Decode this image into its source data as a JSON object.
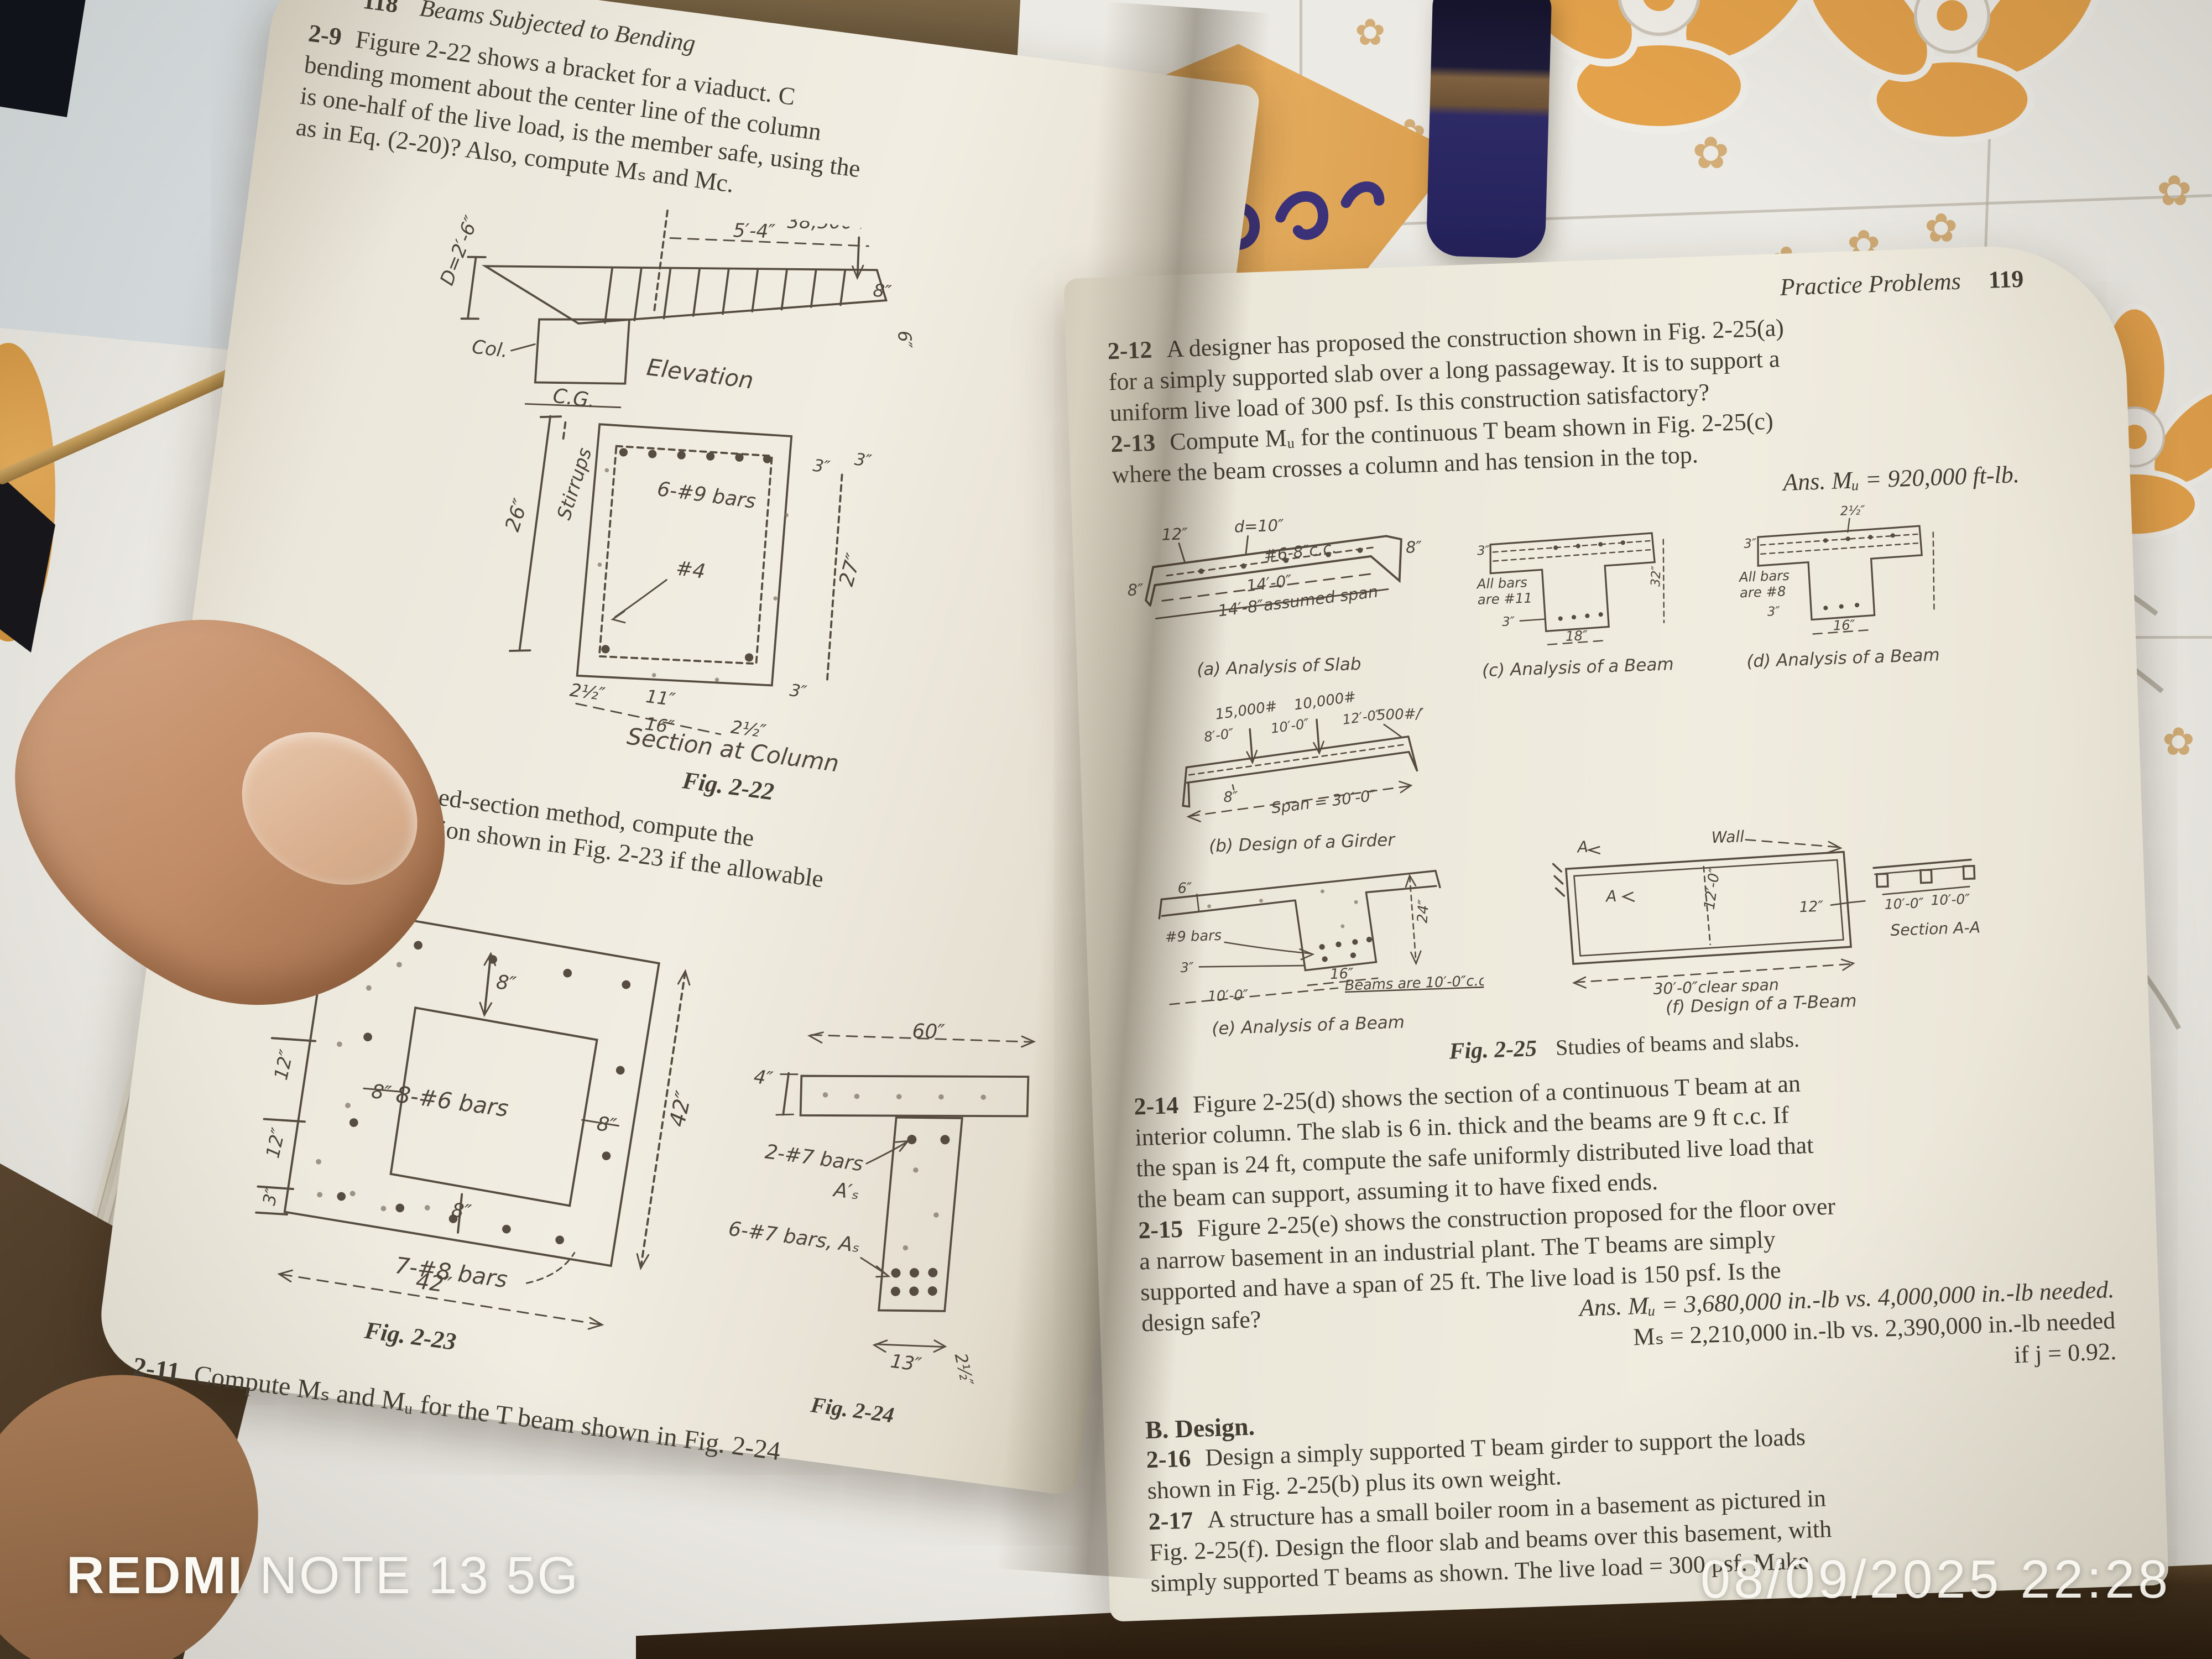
{
  "overlay": {
    "brand": "REDMI",
    "model": "NOTE 13 5G",
    "timestamp": "08/09/2025 22:28"
  },
  "left_page": {
    "page_number": "118",
    "running_title": "Beams Subjected to Bending",
    "p2_9": {
      "num": "2-9",
      "lines": [
        "Figure 2-22 shows a bracket for a viaduct.  C",
        "bending moment about the center line of the column",
        "is one-half of the live load, is the member safe, using the",
        "as in Eq. (2-20)?   Also, compute Mₛ and Mc."
      ]
    },
    "fig22": {
      "depth": "D=2′-6″",
      "col": "Col.",
      "span": "5′-4″",
      "load": "38,500 lb.",
      "dim8": "8″",
      "dim6": "6″",
      "elevation": "Elevation",
      "cg": "C.G.",
      "dim26": "26″",
      "stirrups": "Stirrups",
      "bars": "6-#9 bars",
      "tie": "#4",
      "dim2h_left": "2½″",
      "dim11": "11″",
      "dim2h_right": "2½″",
      "dim16": "16″",
      "dim3_a": "3″",
      "dim3_b": "3″",
      "dim27": "27″",
      "dim3_c": "3″",
      "section": "Section at Column",
      "caption": "Fig. 2-22"
    },
    "p2_10": {
      "num": "2-10",
      "lines": [
        "By the transformed-section method, compute the",
        "moment of the box section shown in Fig. 2-23 if the allowable",
        "psi."
      ]
    },
    "fig23": {
      "d3t": "3″",
      "d12a": "12″",
      "d12b": "12″",
      "d12c": "12″",
      "d3b": "3″",
      "d8top": "8″",
      "d8left": "8″",
      "d8right": "8″",
      "d8bot": "8″",
      "bars_inner": "8-#6 bars",
      "bars_bot": "7-#8 bars",
      "d42b": "42″",
      "d42r": "42″",
      "caption": "Fig. 2-23"
    },
    "fig24": {
      "d4": "4″",
      "d60": "60″",
      "bars_top": "2-#7 bars",
      "as_top": "A′ₛ",
      "bars_bot": "6-#7 bars, Aₛ",
      "d13": "13″",
      "d2h": "2½″",
      "caption": "Fig. 2-24"
    },
    "p2_11": {
      "num": "2-11",
      "line": "Compute Mₛ and Mᵤ for the T beam shown in Fig. 2-24"
    }
  },
  "right_page": {
    "running_title": "Practice Problems",
    "page_number": "119",
    "p2_12": {
      "num": "2-12",
      "lines": [
        "A designer has proposed the construction shown in Fig. 2-25(a)",
        "for a simply supported slab over a long passageway.  It is to support a",
        "uniform live load of 300 psf.  Is this construction satisfactory?"
      ]
    },
    "p2_13": {
      "num": "2-13",
      "lines": [
        "Compute Mᵤ for the continuous T beam shown in Fig. 2-25(c)",
        "where the beam crosses a column and has tension in the top."
      ],
      "ans": "Ans. Mᵤ = 920,000 ft-lb."
    },
    "fig25": {
      "a": {
        "d12": "12″",
        "d10": "d=10″",
        "cc": "#6-8″c.c.",
        "d8r": "8″",
        "d8l": "8″",
        "span": "14′-0″",
        "span2": "14′-8″assumed span",
        "caption": "(a) Analysis of Slab"
      },
      "b": {
        "p1": "15,000#",
        "p2": "10,000#",
        "d1": "8′-0″",
        "d2": "10′-0″",
        "d3": "12′-0″",
        "w": "500#/′",
        "d8": "8″",
        "span": "Span = 30′-0″",
        "caption": "(b) Design of a Girder"
      },
      "c": {
        "d3t": "3″",
        "bars1": "All bars",
        "bars2": "are #11",
        "d3b": "3″",
        "d18": "18″",
        "d32": "32″",
        "caption": "(c) Analysis of a Beam"
      },
      "d": {
        "d2h": "2½″",
        "d3t": "3″",
        "bars1": "All bars",
        "bars2": "are #8",
        "d3b": "3″",
        "d16": "16″",
        "caption": "(d) Analysis of a Beam"
      },
      "e": {
        "d6": "6″",
        "bars": "#9 bars",
        "d3": "3″",
        "d24": "24″",
        "d16": "16″",
        "d10": "10′-0″",
        "cc": "Beams are 10′-0″c.c.",
        "caption": "(e) Analysis of a Beam"
      },
      "f": {
        "a_top": "A",
        "wall": "Wall",
        "a_mid": "A",
        "d12ft": "12′-0″",
        "d12": "12″",
        "span": "30′-0″clear span",
        "d10a": "10′-0″",
        "d10b": "10′-0″",
        "sec": "Section A-A",
        "caption": "(f) Design of a T-Beam"
      },
      "caption_fig": "Fig. 2-25",
      "caption_text": "Studies of beams and slabs."
    },
    "p2_14": {
      "num": "2-14",
      "lines": [
        "Figure 2-25(d) shows the section of a continuous T beam at an",
        "interior column.  The slab is 6 in. thick and the beams are 9 ft c.c.  If",
        "the span is 24 ft, compute the safe uniformly distributed live load that",
        "the beam can support, assuming it to have fixed ends."
      ]
    },
    "p2_15": {
      "num": "2-15",
      "lines": [
        "Figure 2-25(e) shows the construction proposed for the floor over",
        "a narrow basement in an industrial plant.  The T beams are simply",
        "supported and have a span of 25 ft.  The live load is 150 psf.  Is the"
      ],
      "tail": "design safe?",
      "ans1": "Ans. Mᵤ = 3,680,000 in.-lb vs. 4,000,000 in.-lb needed.",
      "ans2": "Mₛ = 2,210,000 in.-lb vs. 2,390,000 in.-lb needed",
      "ans3": "if j = 0.92."
    },
    "section_b": "B.  Design.",
    "p2_16": {
      "num": "2-16",
      "lines": [
        "Design a simply supported T beam girder to support the loads",
        "shown in Fig. 2-25(b) plus its own weight."
      ]
    },
    "p2_17": {
      "num": "2-17",
      "lines": [
        "A structure has a small boiler room in a basement as pictured in",
        "Fig. 2-25(f).  Design the floor slab and beams over this basement, with",
        "simply supported T beams as shown.  The live load = 300 psf.  Make"
      ]
    }
  }
}
